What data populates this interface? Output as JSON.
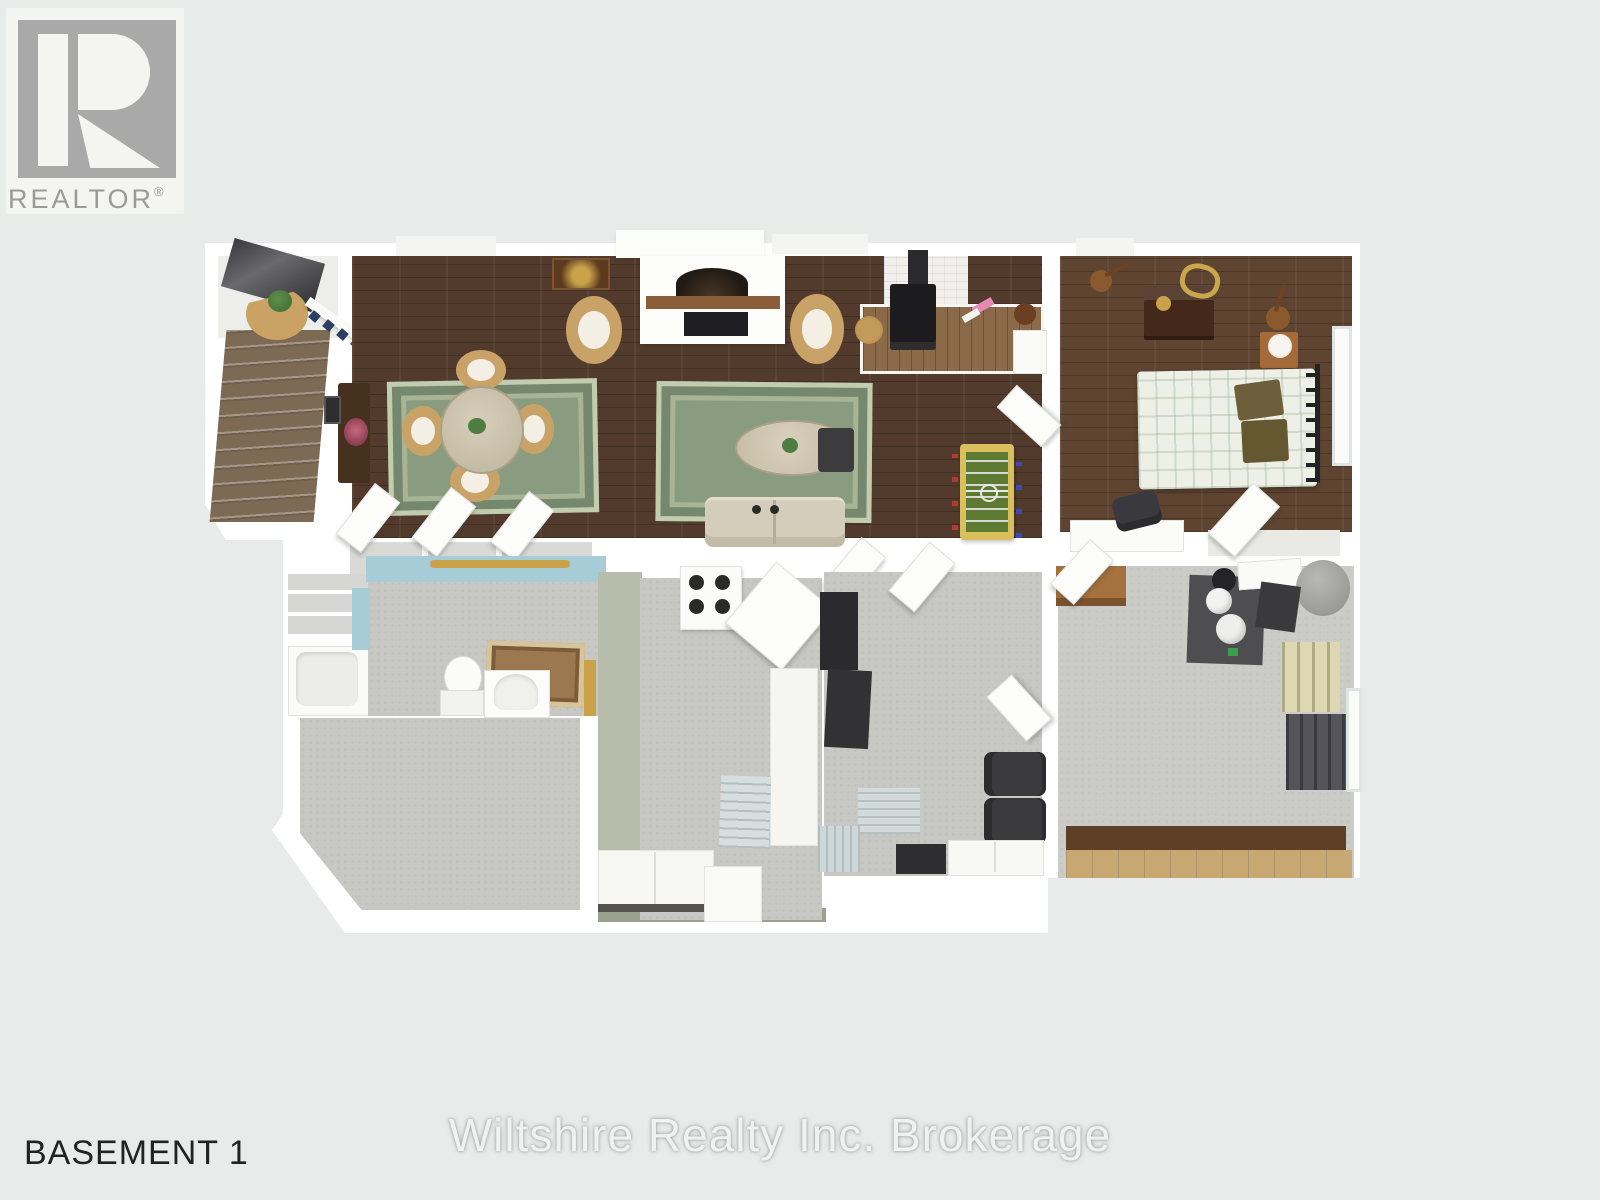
{
  "logo": {
    "text": "REALTOR",
    "registered": "®"
  },
  "labels": {
    "floor": "BASEMENT 1",
    "watermark": "Wiltshire Realty Inc. Brokerage"
  },
  "plan": {
    "type": "3d-floorplan-top-view",
    "level": "Basement",
    "rooms": [
      "staircase",
      "dining-area",
      "living-area",
      "wood-stove-nook",
      "bedroom",
      "bathroom",
      "storage-closet",
      "rec-room",
      "kitchen",
      "den",
      "utility-room"
    ],
    "furniture": [
      "stairs",
      "round-dining-table",
      "wicker-chairs",
      "console-table",
      "area-rug",
      "fireplace-tv",
      "armchairs",
      "sofa",
      "coffee-table",
      "ottoman",
      "wood-stove",
      "foosball-table",
      "bed",
      "dresser",
      "guitars",
      "nightstand",
      "desk",
      "office-chair",
      "toilet",
      "vanity",
      "bathtub",
      "bath-mat",
      "range-stove",
      "kitchen-island",
      "cabinets",
      "water-heater",
      "furnace",
      "shelving",
      "work-bench"
    ]
  },
  "colors": {
    "background": "#e9ebea",
    "wall": "#ffffff",
    "wood_floor": "#523b2c",
    "bedroom_floor": "#5e4431",
    "carpet": "#c7c7c3",
    "rug_green": "#8a9c80",
    "stairs": "#7d6a55",
    "accent_blue": "#a6ccd8",
    "sage_wall": "#b7bdaa",
    "platform_wood": "#8a6a48",
    "bench_wood": "#5d4026",
    "logo_gray": "#a9a9a9"
  }
}
